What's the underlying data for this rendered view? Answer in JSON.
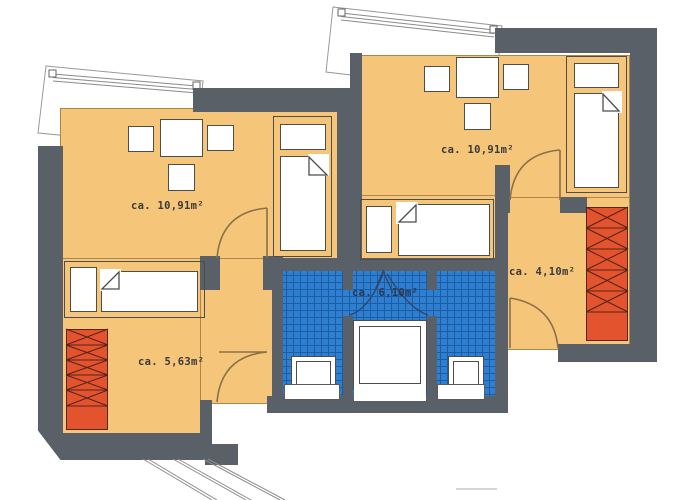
{
  "plan": {
    "rooms": [
      {
        "name": "bedroom-left",
        "area_label": "ca. 10,91m²"
      },
      {
        "name": "bedroom-right",
        "area_label": "ca. 10,91m²"
      },
      {
        "name": "hall-left",
        "area_label": "ca. 5,63m²"
      },
      {
        "name": "hall-right",
        "area_label": "ca. 4,10m²"
      },
      {
        "name": "bathroom",
        "area_label": "ca. 6,10m²"
      }
    ],
    "colors": {
      "wall": "#5a6067",
      "room_fill": "#f5c67a",
      "tile_fill": "#2f7fd1",
      "tile_grid": "#1c5ca5",
      "wardrobe_fill": "#e2532e",
      "furniture_outline": "#4d4d4d",
      "door_arc": "#8a7048",
      "line": "#8b8b8b",
      "label_text": "#3a3a3a"
    }
  }
}
